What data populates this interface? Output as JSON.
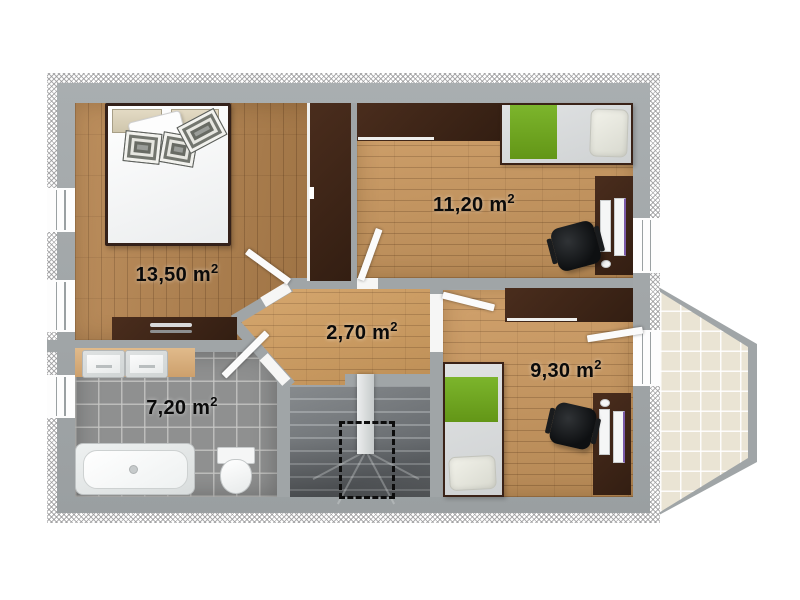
{
  "plan_title": "apartment floor plan - upper storey",
  "rooms": {
    "bedroom": {
      "area": "13,50 m",
      "sup": "2"
    },
    "room_top_right": {
      "area": "11,20 m",
      "sup": "2"
    },
    "hallway": {
      "area": "2,70 m",
      "sup": "2"
    },
    "room_bottom_right": {
      "area": "9,30 m",
      "sup": "2"
    },
    "bathroom": {
      "area": "7,20 m",
      "sup": "2"
    }
  },
  "colors": {
    "wall_gray": "#a0a5a7",
    "wood_dark": "#b6834c",
    "wood_light": "#cd9a60",
    "bathroom_tile": "#8f9090",
    "balcony_tile": "#eae4d4",
    "accent_green": "#6fa422",
    "furniture_dark": "#3e2417",
    "label_text": "#0a0a0a"
  }
}
